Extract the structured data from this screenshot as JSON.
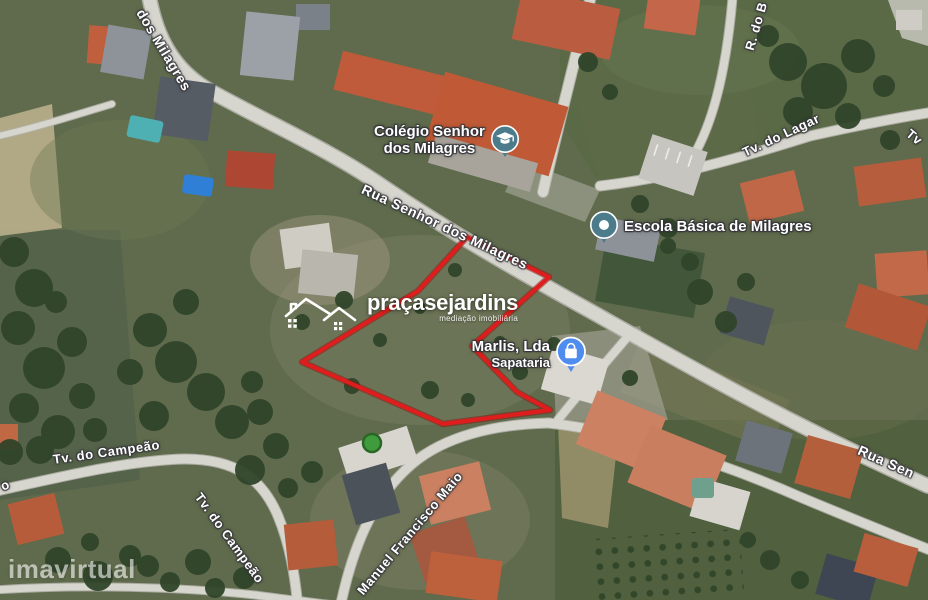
{
  "source_watermark": "imavirtual",
  "brand": {
    "name": "praçasejardins",
    "tagline": "mediação imobiliária"
  },
  "map": {
    "view": "satellite",
    "parcel_outline_color": "#e01d1d",
    "road_labels": [
      {
        "text": "dos Milagres"
      },
      {
        "text": "Rua Senhor dos Milagres"
      },
      {
        "text": "R. do B"
      },
      {
        "text": "Tv. do Lagar"
      },
      {
        "text": "Tv"
      },
      {
        "text": "Tv. do Campeão"
      },
      {
        "text": "Tv. do Campeão"
      },
      {
        "text": "o"
      },
      {
        "text": "Manuel Francisco Maio"
      },
      {
        "text": "Rua Sen"
      }
    ],
    "pois": [
      {
        "id": "colegio",
        "line1": "Colégio Senhor",
        "line2": "dos Milagres",
        "icon": "school-icon",
        "icon_color": "#4c7c8c"
      },
      {
        "id": "escola",
        "label": "Escola Básica de Milagres",
        "icon": "place-pin-icon",
        "icon_color": "#4c7c8c"
      },
      {
        "id": "marlis",
        "line1": "Marlis, Lda",
        "line2": "Sapataria",
        "icon": "shopping-icon",
        "icon_color": "#4e8cf0"
      }
    ]
  }
}
